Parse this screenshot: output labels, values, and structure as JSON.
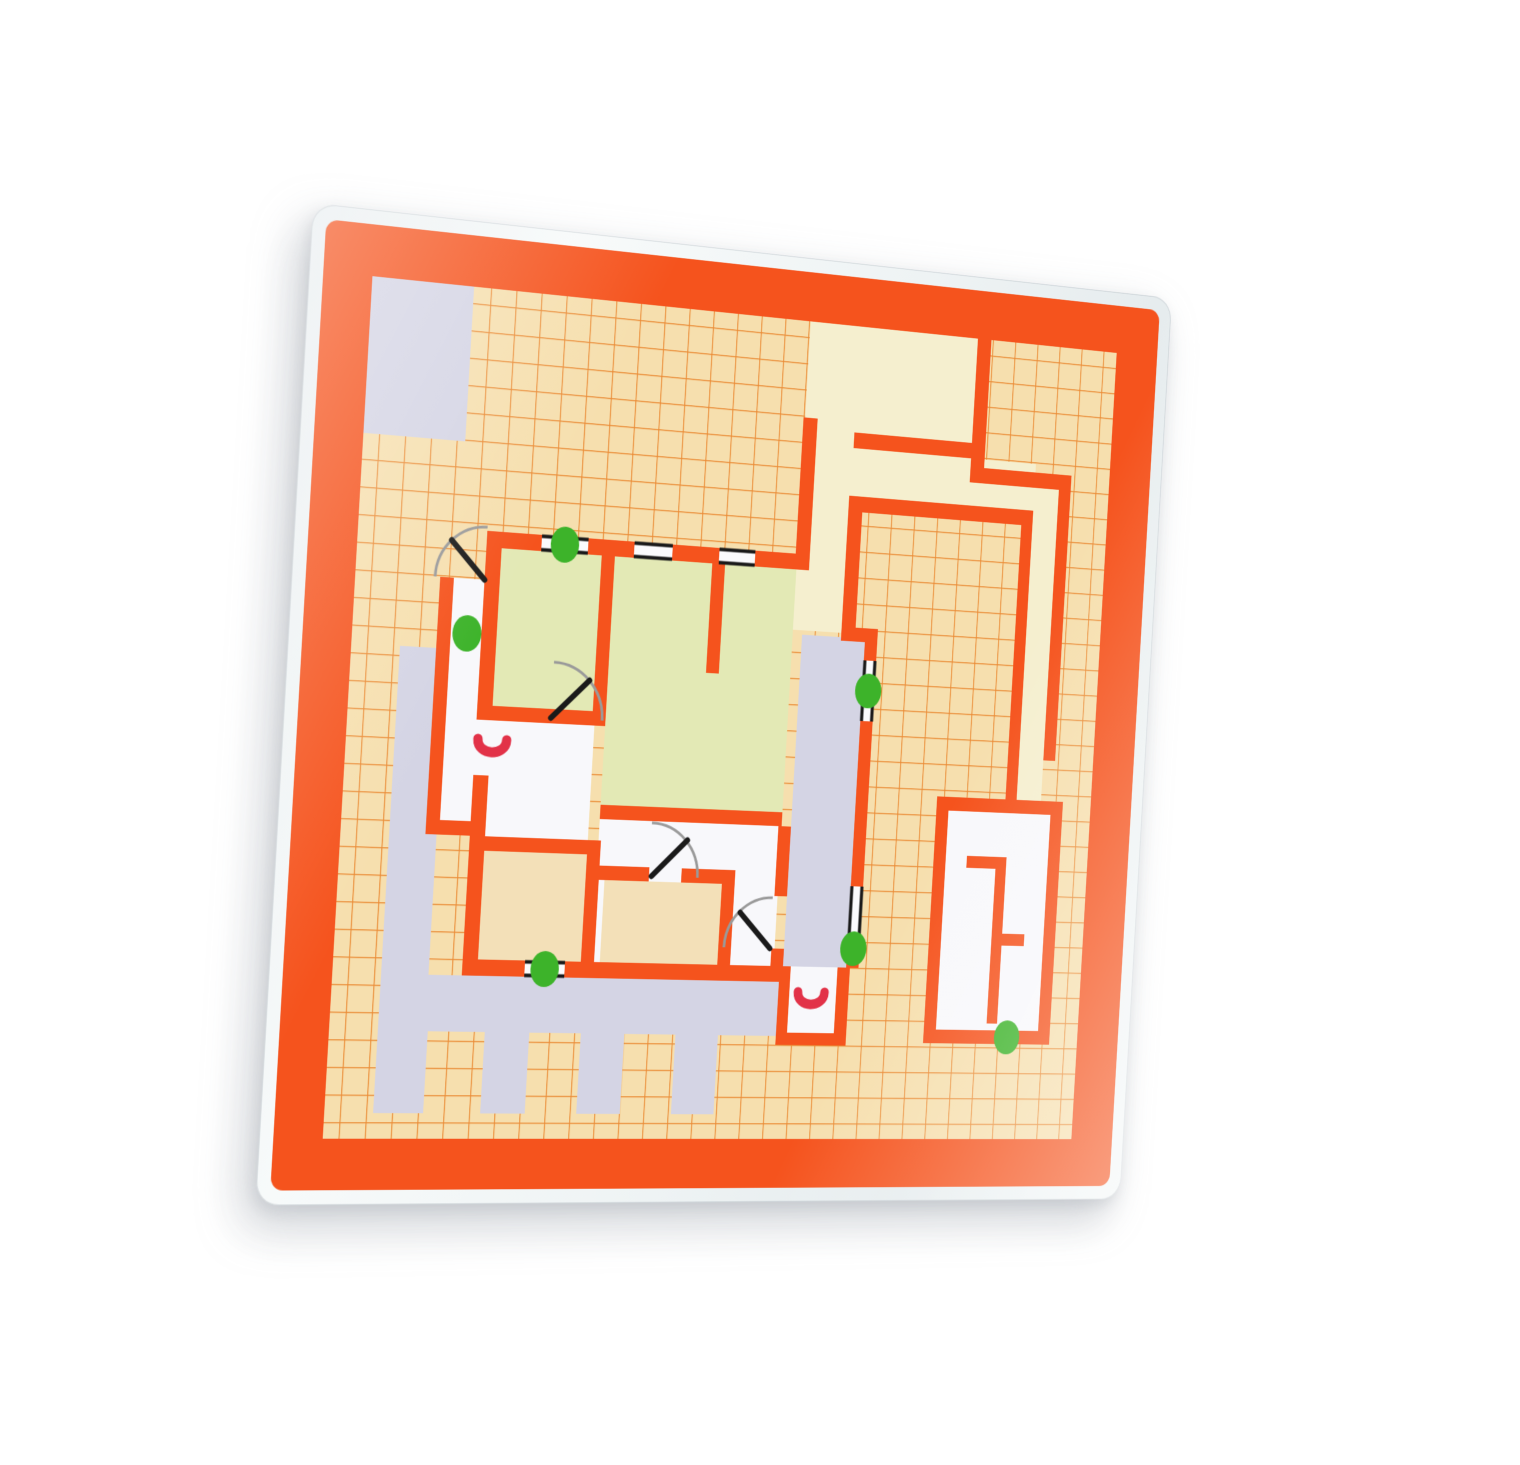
{
  "scene": {
    "description": "photograph of a laminated evacuation floor-plan card on white background",
    "background_color": "#ffffff",
    "laminate_color": "#eef3f4"
  },
  "palette": {
    "orange": "#f5531d",
    "grid_line": "#e87d20",
    "paper": "#f6dfae",
    "cream": "#f5efcf",
    "green_room": "#e3e9b5",
    "tan_room": "#f3e0b8",
    "white_room": "#f8f8fb",
    "lavender": "#d4d4e4",
    "exit_dot": "#3db32a",
    "red_symbol": "#e23248",
    "door_arc": "#9a9a9a",
    "door_leaf": "#1a1a1a",
    "window_line": "#1a1a1a"
  },
  "plan": {
    "size": 1080,
    "laminate_margin": 16,
    "frame_thickness": 56,
    "map_rect": [
      72,
      72,
      936,
      936
    ],
    "grid_cell": 30,
    "regions": [
      {
        "name": "lavender-patch-top-left",
        "role": "lavender",
        "rect": [
          72,
          72,
          118,
          170
        ]
      },
      {
        "name": "cream-top-band",
        "role": "cream",
        "rect": [
          602,
          72,
          218,
          122
        ]
      },
      {
        "name": "cream-corridor-opening",
        "role": "cream",
        "rect": [
          618,
          194,
          48,
          18
        ]
      },
      {
        "name": "cream-north-corridor",
        "role": "cream",
        "rect": [
          602,
          212,
          78,
          213
        ]
      },
      {
        "name": "cream-band-above-courtyard",
        "role": "cream",
        "rect": [
          666,
          212,
          241,
          55
        ]
      },
      {
        "name": "cream-east-column",
        "role": "cream",
        "rect": [
          907,
          240,
          33,
          368
        ]
      },
      {
        "name": "green-room-northwest",
        "role": "green_room",
        "rect": [
          240,
          356,
          120,
          174
        ]
      },
      {
        "name": "green-room-north",
        "role": "green_room",
        "rect": [
          376,
          356,
          226,
          294
        ]
      },
      {
        "name": "white-porch",
        "role": "white_room",
        "rect": [
          186,
          392,
          36,
          266
        ]
      },
      {
        "name": "white-alcove-west",
        "role": "white_room",
        "rect": [
          222,
          545,
          44,
          62
        ]
      },
      {
        "name": "white-room-west",
        "role": "white_room",
        "rect": [
          240,
          546,
          123,
          128
        ]
      },
      {
        "name": "white-room-center",
        "role": "white_room",
        "rect": [
          376,
          650,
          226,
          160
        ]
      },
      {
        "name": "tan-room-south-1",
        "role": "tan_room",
        "rect": [
          240,
          690,
          123,
          120
        ]
      },
      {
        "name": "tan-room-south-2",
        "role": "tan_room",
        "rect": [
          386,
          718,
          145,
          92
        ]
      },
      {
        "name": "lavender-loggia-east",
        "role": "lavender",
        "rect": [
          614,
          430,
          81,
          380
        ]
      },
      {
        "name": "terrace-lavender",
        "role": "lavender",
        "points": [
          [
            128,
            470
          ],
          [
            183,
            470
          ],
          [
            183,
            828
          ],
          [
            620,
            828
          ],
          [
            620,
            890
          ],
          [
            537,
            890
          ],
          [
            537,
            980
          ],
          [
            484,
            980
          ],
          [
            484,
            890
          ],
          [
            421,
            890
          ],
          [
            421,
            980
          ],
          [
            368,
            980
          ],
          [
            368,
            890
          ],
          [
            306,
            890
          ],
          [
            306,
            980
          ],
          [
            253,
            980
          ],
          [
            253,
            890
          ],
          [
            186,
            890
          ],
          [
            186,
            980
          ],
          [
            128,
            980
          ]
        ]
      },
      {
        "name": "white-alcove-southeast",
        "role": "white_room",
        "rect": [
          624,
          810,
          60,
          76
        ]
      },
      {
        "name": "white-room-east",
        "role": "white_room",
        "rect": [
          817,
          624,
          137,
          256
        ]
      }
    ],
    "walls": [
      {
        "name": "building-north-wall",
        "rect": [
          222,
          338,
          396,
          18
        ]
      },
      {
        "name": "building-west-wall-upper",
        "rect": [
          222,
          338,
          18,
          207
        ]
      },
      {
        "name": "building-west-wall-lower",
        "rect": [
          222,
          607,
          18,
          221
        ]
      },
      {
        "name": "porch-west-wall",
        "rect": [
          170,
          392,
          16,
          282
        ]
      },
      {
        "name": "porch-south-wall",
        "rect": [
          170,
          658,
          70,
          16
        ]
      },
      {
        "name": "building-south-wall",
        "rect": [
          222,
          810,
          392,
          18
        ]
      },
      {
        "name": "wall-a-b",
        "rect": [
          360,
          356,
          16,
          190
        ]
      },
      {
        "name": "wall-below-room-a",
        "rect": [
          222,
          530,
          154,
          16
        ]
      },
      {
        "name": "wall-b-c-partial",
        "rect": [
          496,
          356,
          16,
          124
        ]
      },
      {
        "name": "green-south-wall",
        "rect": [
          376,
          634,
          226,
          16
        ]
      },
      {
        "name": "tan1-north-wall",
        "rect": [
          228,
          674,
          151,
          16
        ]
      },
      {
        "name": "tan1-east-wall",
        "rect": [
          363,
          674,
          16,
          152
        ]
      },
      {
        "name": "tan2-north-wall-left",
        "rect": [
          370,
          702,
          70,
          16
        ]
      },
      {
        "name": "tan2-north-wall-right",
        "rect": [
          480,
          702,
          67,
          16
        ]
      },
      {
        "name": "tan2-east-wall",
        "rect": [
          531,
          702,
          16,
          124
        ]
      },
      {
        "name": "loggia-west-wall-upper",
        "rect": [
          598,
          650,
          16,
          80
        ]
      },
      {
        "name": "loggia-west-wall-lower",
        "rect": [
          598,
          790,
          16,
          36
        ]
      },
      {
        "name": "north-spur-wall",
        "rect": [
          600,
          182,
          18,
          168
        ]
      },
      {
        "name": "floating-wall-top",
        "rect": [
          666,
          194,
          154,
          18
        ]
      },
      {
        "name": "grid-patch-west-wall",
        "rect": [
          820,
          72,
          18,
          168
        ]
      },
      {
        "name": "grid-patch-south-wall",
        "rect": [
          820,
          222,
          136,
          18
        ]
      },
      {
        "name": "long-east-wall",
        "rect": [
          940,
          240,
          16,
          320
        ]
      },
      {
        "name": "courtyard-north-wall",
        "rect": [
          664,
          267,
          243,
          18
        ]
      },
      {
        "name": "courtyard-west-wall-upper",
        "rect": [
          664,
          267,
          18,
          158
        ]
      },
      {
        "name": "courtyard-step-stub",
        "rect": [
          664,
          418,
          47,
          16
        ]
      },
      {
        "name": "building-east-wall",
        "rect": [
          695,
          425,
          16,
          385
        ]
      },
      {
        "name": "courtyard-east-wall",
        "rect": [
          892,
          285,
          15,
          323
        ]
      },
      {
        "name": "se-alcove-west-wall",
        "rect": [
          610,
          810,
          14,
          90
        ]
      },
      {
        "name": "se-alcove-south-wall",
        "rect": [
          610,
          886,
          88,
          14
        ]
      },
      {
        "name": "se-alcove-east-wall",
        "rect": [
          684,
          810,
          16,
          90
        ]
      },
      {
        "name": "east-room-north-wall",
        "rect": [
          801,
          608,
          169,
          16
        ]
      },
      {
        "name": "east-room-west-wall",
        "rect": [
          801,
          608,
          16,
          288
        ]
      },
      {
        "name": "east-room-south-wall",
        "rect": [
          801,
          880,
          169,
          16
        ]
      },
      {
        "name": "east-room-east-wall",
        "rect": [
          954,
          608,
          16,
          288
        ]
      },
      {
        "name": "east-room-stub-top",
        "rect": [
          845,
          676,
          53,
          14
        ]
      },
      {
        "name": "east-room-inner-vertical",
        "rect": [
          884,
          676,
          14,
          196
        ]
      },
      {
        "name": "east-room-stub-right",
        "rect": [
          898,
          766,
          30,
          14
        ]
      }
    ],
    "windows": [
      {
        "name": "window-north-1",
        "rect": [
          287,
          338,
          56,
          18
        ],
        "orient": "h"
      },
      {
        "name": "window-north-2",
        "rect": [
          399,
          338,
          47,
          18
        ],
        "orient": "h"
      },
      {
        "name": "window-north-3",
        "rect": [
          504,
          338,
          45,
          18
        ],
        "orient": "h"
      },
      {
        "name": "window-east-1",
        "rect": [
          695,
          455,
          16,
          70
        ],
        "orient": "v"
      },
      {
        "name": "window-east-2",
        "rect": [
          695,
          716,
          16,
          72
        ],
        "orient": "v"
      },
      {
        "name": "window-south-1",
        "rect": [
          296,
          810,
          48,
          18
        ],
        "orient": "h"
      }
    ],
    "doors": [
      {
        "name": "door-porch-entry",
        "arc": "M 164,392 A 58,58 0 0 1 222,334",
        "leaf": [
          [
            222,
            392
          ],
          [
            181,
            351
          ]
        ]
      },
      {
        "name": "door-room-a",
        "arc": "M 310,478 A 62,62 0 0 1 372,540",
        "leaf": [
          [
            310,
            540
          ],
          [
            354,
            496
          ]
        ]
      },
      {
        "name": "door-center",
        "arc": "M 440,652 A 60,60 0 0 1 500,712",
        "leaf": [
          [
            443,
            712
          ],
          [
            485,
            670
          ]
        ]
      },
      {
        "name": "door-southeast",
        "arc": "M 538,790 A 58,58 0 0 1 596,732",
        "leaf": [
          [
            596,
            790
          ],
          [
            556,
            750
          ]
        ]
      }
    ],
    "exit_dots": [
      {
        "name": "exit-dot-north",
        "cx": 315,
        "cy": 347
      },
      {
        "name": "exit-dot-porch",
        "cx": 205,
        "cy": 452
      },
      {
        "name": "exit-dot-east-upper",
        "cx": 703,
        "cy": 490
      },
      {
        "name": "exit-dot-east-lower",
        "cx": 703,
        "cy": 788
      },
      {
        "name": "exit-dot-south",
        "cx": 320,
        "cy": 819
      },
      {
        "name": "exit-dot-east-room",
        "cx": 912,
        "cy": 888
      }
    ],
    "red_symbols": [
      {
        "name": "red-u-symbol-west",
        "cx": 242,
        "cy": 576
      },
      {
        "name": "red-u-symbol-southeast",
        "cx": 652,
        "cy": 848
      }
    ]
  }
}
